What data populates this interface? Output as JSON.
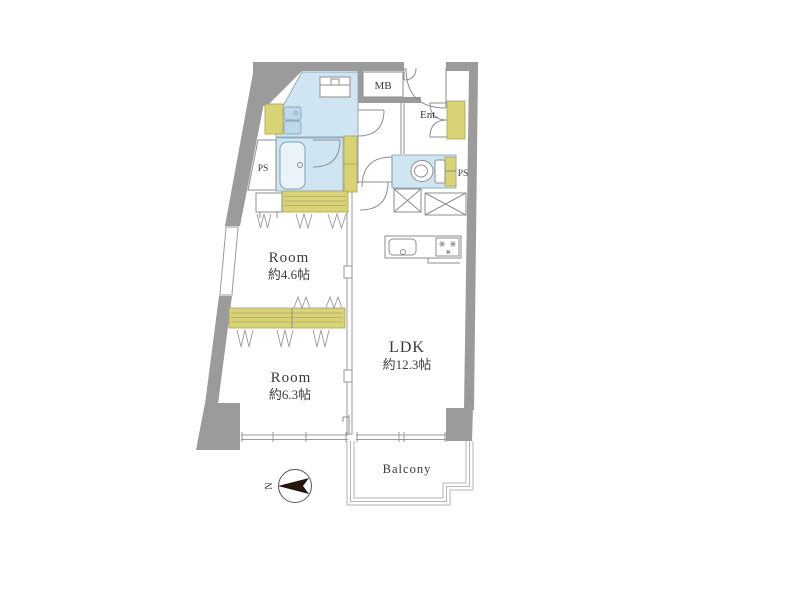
{
  "floorplan": {
    "labels": {
      "room_a_name": "Room",
      "room_a_size": "約4.6帖",
      "room_b_name": "Room",
      "room_b_size": "約6.3帖",
      "ldk_name": "LDK",
      "ldk_size": "約12.3帖",
      "balcony": "Balcony",
      "entrance": "Ent.",
      "meter_box": "MB",
      "pipe_shaft_left": "PS",
      "pipe_shaft_right": "PS",
      "compass_north": "N"
    },
    "colors": {
      "wall": "#9b9b9b",
      "water_area": "#cfe5f1",
      "fixture_blue": "#bcd9ea",
      "storage_yellow": "#d9d377",
      "bathtub": "#eaf3fa",
      "compass_arrow": "#26170d",
      "background": "#ffffff"
    }
  }
}
